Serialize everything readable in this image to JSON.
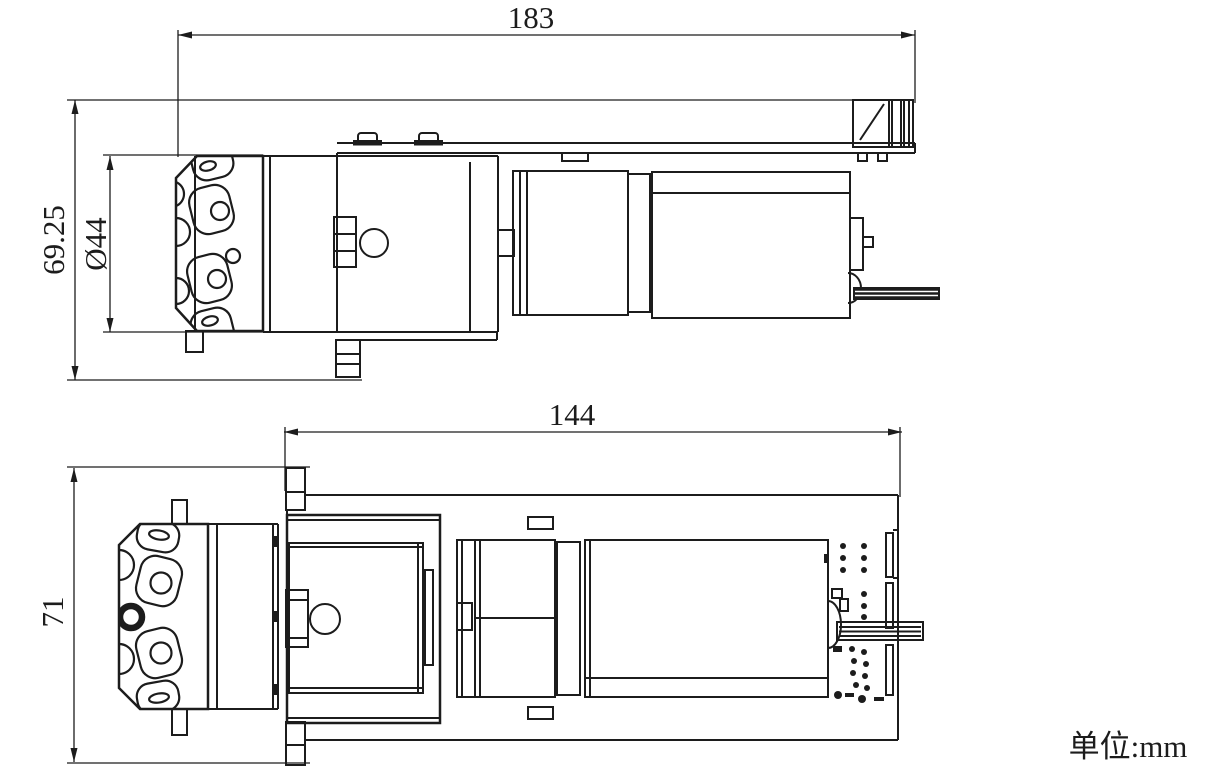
{
  "drawing": {
    "background": "#ffffff",
    "line_color": "#1c1c1c",
    "unit_label": "单位:mm",
    "views": [
      {
        "name": "side-elevation-view",
        "dimensions": [
          {
            "id": "overall-length",
            "label": "183",
            "orientation": "horizontal"
          },
          {
            "id": "overall-height",
            "label": "69.25",
            "orientation": "vertical"
          },
          {
            "id": "head-diameter",
            "label": "Ø44",
            "orientation": "vertical"
          }
        ]
      },
      {
        "name": "plan-view",
        "dimensions": [
          {
            "id": "plate-length",
            "label": "144",
            "orientation": "horizontal"
          },
          {
            "id": "plate-width",
            "label": "71",
            "orientation": "vertical"
          }
        ]
      }
    ]
  }
}
